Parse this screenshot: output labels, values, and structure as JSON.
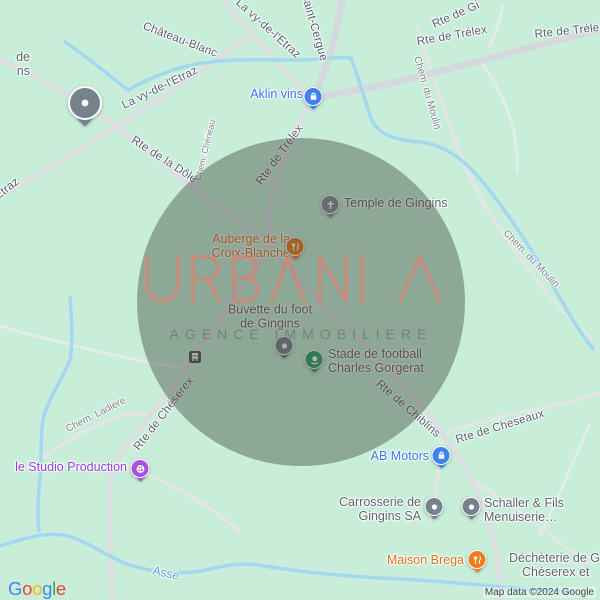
{
  "watermark": {
    "brand": "URBANIA",
    "tagline": "AGENCE IMMOBILIERE",
    "brand_color": "#ef7765",
    "tagline_color": "#5f6c66"
  },
  "overlay_circle": {
    "color_rgba": "rgba(56,62,52,0.40)"
  },
  "colors": {
    "map_background": "#c8eeda",
    "road": "#d5d8dd",
    "water": "#a3d8f0",
    "road_label": "#57606e",
    "street_label": "#7b838c",
    "poi_gray_label": "#5d656b",
    "poi_blue": "#3c76e8",
    "poi_orange": "#d9731c",
    "poi_purple": "#9340d6",
    "poi_green_pin": "#2aa06a",
    "water_label": "#54a4d4"
  },
  "road_labels": [
    {
      "text": "Château-Blanc"
    },
    {
      "text": "La vy-de-l'Etraz"
    },
    {
      "text": "Saint-Cergue"
    },
    {
      "text": "Rte de Gi"
    },
    {
      "text": "Rte de Trélex"
    },
    {
      "text": "Rte de Trélex"
    },
    {
      "text": "Chem. du Moulin"
    },
    {
      "text": "La vy-de-l'Etraz"
    },
    {
      "text": "Etraz"
    },
    {
      "text": "Rte de la Dôle"
    },
    {
      "text": "Chem. Chéneau"
    },
    {
      "text": "Rte de Trélex"
    },
    {
      "text": "Chem. du Moulin"
    },
    {
      "text": "Rte de Chéserex"
    },
    {
      "text": "Chem. Ladiere"
    },
    {
      "text": "Rte de Chiblins"
    },
    {
      "text": "Rte de Cheseaux"
    }
  ],
  "water_label": {
    "text": "Asse"
  },
  "pois": [
    {
      "label_lines": [
        "de",
        "ns"
      ],
      "type": "generic-partial",
      "pin": "gray-large"
    },
    {
      "label": "Aklin vins",
      "type": "shop",
      "pin": "blue-bag"
    },
    {
      "label": "Temple de Gingins",
      "type": "church",
      "pin": "gray-cross"
    },
    {
      "label_lines": [
        "Auberge de la",
        "Croix-Blanche"
      ],
      "type": "restaurant",
      "pin": "orange-restaurant"
    },
    {
      "label_lines": [
        "Buvette du foot",
        "de Gingins"
      ],
      "type": "generic",
      "pin": "gray-dot"
    },
    {
      "label_lines": [
        "Stade de football",
        "Charles Gorgerat"
      ],
      "type": "sports",
      "pin": "green-sports"
    },
    {
      "label": "le Studio Production",
      "type": "art",
      "pin": "purple-palette"
    },
    {
      "label": "AB Motors",
      "type": "shop",
      "pin": "blue-bag"
    },
    {
      "label_lines": [
        "Carrosserie de",
        "Gingins SA"
      ],
      "type": "generic",
      "pin": "gray-dot"
    },
    {
      "label_lines": [
        "Schaller & Fils",
        "Menuiserie…"
      ],
      "type": "generic",
      "pin": "gray-dot"
    },
    {
      "label": "Maison Brega",
      "type": "restaurant",
      "pin": "orange-restaurant"
    },
    {
      "label_lines": [
        "Déchèterie de G",
        "Chéserex et"
      ],
      "type": "generic",
      "pin": null
    }
  ],
  "transit_stop": {
    "icon": "bus"
  },
  "footer": {
    "attribution": "Map data ©2024 Google",
    "logo_text": "Google",
    "logo_letters": [
      {
        "ch": "G",
        "color": "#4285F4"
      },
      {
        "ch": "o",
        "color": "#EA4335"
      },
      {
        "ch": "o",
        "color": "#FBBC05"
      },
      {
        "ch": "g",
        "color": "#4285F4"
      },
      {
        "ch": "l",
        "color": "#34A853"
      },
      {
        "ch": "e",
        "color": "#EA4335"
      }
    ]
  }
}
